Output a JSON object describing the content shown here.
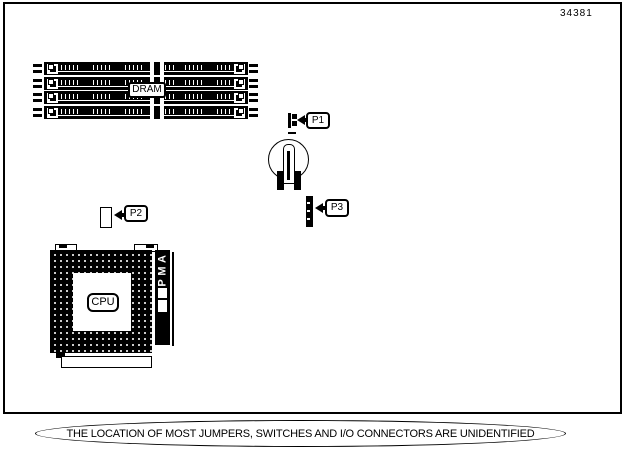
{
  "page": {
    "part_number": "34381",
    "footnote": "THE LOCATION OF MOST JUMPERS, SWITCHES AND I/O CONNECTORS ARE UNIDENTIFIED"
  },
  "diagram": {
    "dram": {
      "label": "DRAM",
      "module_count": 4
    },
    "cpu": {
      "label": "CPU"
    },
    "amp": {
      "label": "AMP",
      "letters": [
        "A",
        "M",
        "P"
      ]
    },
    "jumpers": [
      {
        "id": "P1"
      },
      {
        "id": "P2"
      },
      {
        "id": "P3"
      }
    ],
    "battery": {
      "name": "battery"
    }
  },
  "colors": {
    "ink": "#000000",
    "paper": "#ffffff"
  }
}
